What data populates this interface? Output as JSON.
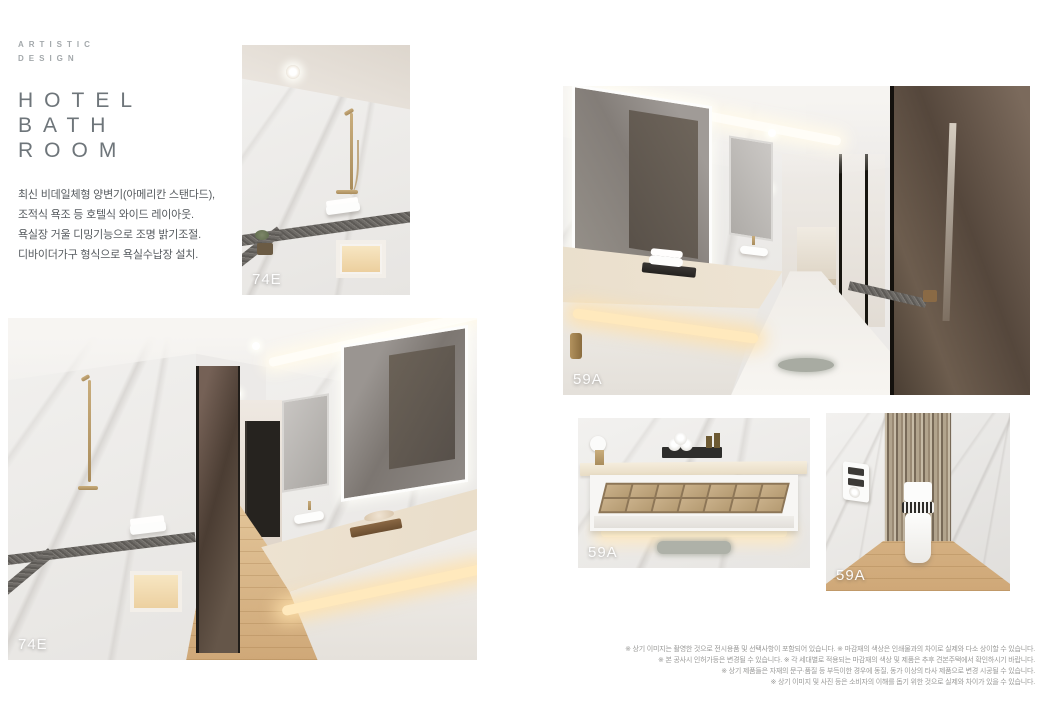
{
  "header": {
    "eyebrow": [
      "ARTISTIC",
      "DESIGN"
    ],
    "title": [
      "HOTEL",
      "BATH",
      "ROOM"
    ],
    "description": [
      "최신 비데일체형 양변기(아메리칸 스탠다드),",
      "조적식 욕조 등 호텔식 와이드 레이아웃.",
      "욕실장 거울 디밍기능으로 조명 밝기조절.",
      "디바이더가구 형식으로 욕실수납장 설치."
    ]
  },
  "photos": {
    "shower_top": {
      "label": "74E"
    },
    "bath_left": {
      "label": "74E"
    },
    "bath_right": {
      "label": "59A"
    },
    "drawer": {
      "label": "59A"
    },
    "toilet": {
      "label": "59A"
    }
  },
  "disclaimer": [
    "※ 상기 이미지는 촬영한 것으로 전시용품 및 선택사항이 포함되어 있습니다. ※ 마감재의 색상은 인쇄물과의 차이로 실제와 다소 상이할 수 있습니다.",
    "※ 본 공사시 인허가등은 변경될 수 있습니다. ※ 각 세대별로 적용되는 마감재의 색상 및 제품은 추후 견본주택에서 확인하시기 바랍니다.",
    "※ 상기 제품들은 자재의 문구·품질 등 부득이한 경우에 동질, 동가 이상의 타사 제품으로 변경 시공될 수 있습니다.",
    "※ 상기 이미지 및 사진 등은 소비자의 이해를 돕기 위한 것으로 실제와 차이가 있을 수 있습니다."
  ],
  "colors": {
    "title_gray": "#6e757a",
    "brass_gold": "#b79a6b",
    "granite": "#6d6a66",
    "wood_floor": "#d8b285",
    "marble": "#f0eeec",
    "label_text": "#ffffff"
  }
}
